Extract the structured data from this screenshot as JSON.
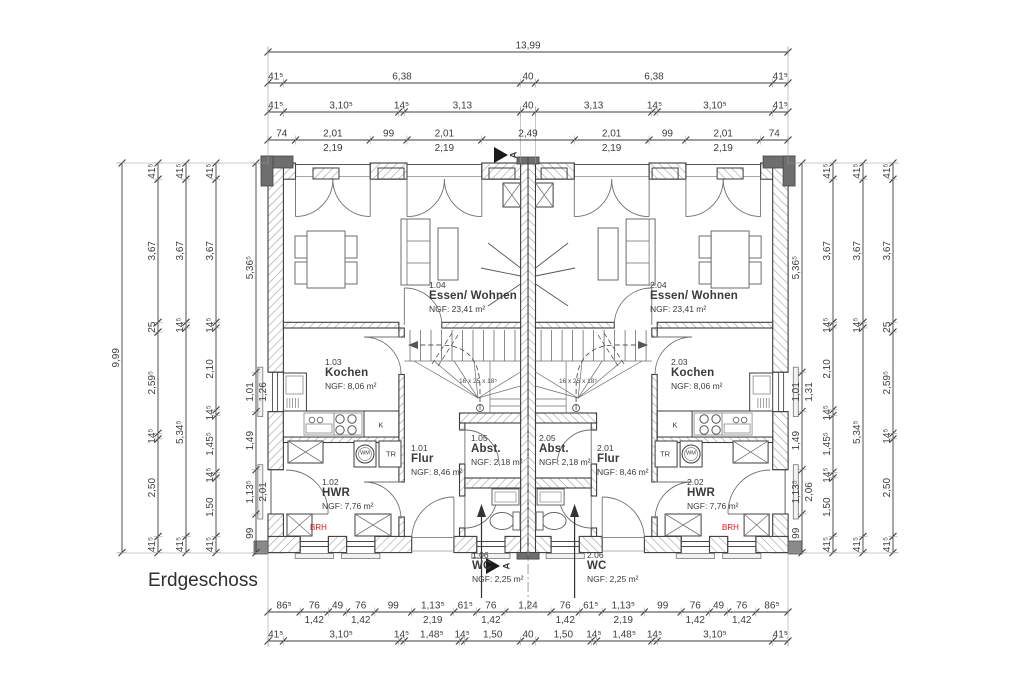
{
  "title": {
    "floor_label": "Erdgeschoss"
  },
  "labels": {
    "fridge": "K",
    "dryer": "TR",
    "washer": "WM",
    "brh": "BRH",
    "stair_spec": "16 x 25 x 18⁵",
    "section": "A"
  },
  "colors": {
    "line": "#3d3d3d",
    "hatch": "#a0a0a0",
    "furniture": "#6d6d6d",
    "dark_fill": "#6e6e6e",
    "accent_red": "#cc2222",
    "background": "#ffffff"
  },
  "units": [
    {
      "id": "1",
      "rooms": {
        "flur": {
          "number": "1.01",
          "name": "Flur",
          "area": "NGF: 8,46 m²"
        },
        "hwr": {
          "number": "1.02",
          "name": "HWR",
          "area": "NGF: 7,76 m²"
        },
        "kochen": {
          "number": "1.03",
          "name": "Kochen",
          "area": "NGF: 8,06 m²"
        },
        "wohnen": {
          "number": "1.04",
          "name": "Essen/ Wohnen",
          "area": "NGF: 23,41 m²"
        },
        "abst": {
          "number": "1.05",
          "name": "Abst.",
          "area": "NGF: 2,18 m²"
        },
        "wc": {
          "number": "1.06",
          "name": "WC",
          "area": "NGF: 2,25 m²"
        }
      }
    },
    {
      "id": "2",
      "rooms": {
        "flur": {
          "number": "2.01",
          "name": "Flur",
          "area": "NGF: 8,46 m²"
        },
        "hwr": {
          "number": "2.02",
          "name": "HWR",
          "area": "NGF: 7,76 m²"
        },
        "kochen": {
          "number": "2.03",
          "name": "Kochen",
          "area": "NGF: 8,06 m²"
        },
        "wohnen": {
          "number": "2.04",
          "name": "Essen/ Wohnen",
          "area": "NGF: 23,41 m²"
        },
        "abst": {
          "number": "2.05",
          "name": "Abst.",
          "area": "NGF: 2,18 m²"
        },
        "wc": {
          "number": "2.06",
          "name": "WC",
          "area": "NGF: 2,25 m²"
        }
      }
    }
  ],
  "dimensions": {
    "top_rows": [
      {
        "segments": [
          "13,99"
        ]
      },
      {
        "segments": [
          "41⁵",
          "6,38",
          "40",
          "6,38",
          "41⁵"
        ]
      },
      {
        "segments": [
          "41⁵",
          "3,10⁵",
          "14⁵",
          "3,13",
          "40",
          "3,13",
          "14⁵",
          "3,10⁵",
          "41⁵"
        ]
      },
      {
        "segments": [
          "74",
          [
            "2,01",
            "2,19"
          ],
          "99",
          [
            "2,01",
            "2,19"
          ],
          "2,49",
          [
            "2,01",
            "2,19"
          ],
          "99",
          [
            "2,01",
            "2,19"
          ],
          "74"
        ]
      }
    ],
    "left_cols": [
      {
        "segments": [
          "9,99"
        ]
      },
      {
        "segments": [
          "41⁵",
          "3,67",
          "25",
          "2,59⁵",
          "14⁵",
          "2,50",
          "41⁵"
        ]
      },
      {
        "segments": [
          "41⁵",
          "3,67",
          "14⁵",
          "5,34⁵",
          "41⁵"
        ]
      },
      {
        "segments": [
          "41⁵",
          "3,67",
          "14⁵",
          "2,10",
          "14⁵",
          "1,45⁵",
          "14⁵",
          "1,50",
          "41⁵"
        ]
      },
      {
        "segments": [
          "5,36⁵",
          [
            "1,01",
            "1,26"
          ],
          "1,49",
          [
            "1,13⁵",
            "2,01"
          ],
          "99"
        ]
      }
    ],
    "right_cols": [
      {
        "segments": [
          "5,36⁵",
          [
            "1,01",
            "1,31"
          ],
          "1,49",
          [
            "1,13⁵",
            "2,06"
          ],
          "99"
        ]
      },
      {
        "segments": [
          "41⁵",
          "3,67",
          "14⁵",
          "2,10",
          "14⁵",
          "1,45⁵",
          "14⁵",
          "1,50",
          "41⁵"
        ]
      },
      {
        "segments": [
          "41⁵",
          "3,67",
          "14⁵",
          "5,34⁵",
          "41⁵"
        ]
      },
      {
        "segments": [
          "41⁵",
          "3,67",
          "25",
          "2,59⁵",
          "14⁵",
          "2,50",
          "41⁵"
        ]
      }
    ],
    "bottom_rows": [
      {
        "segments": [
          "86⁵",
          [
            "76",
            "1,42"
          ],
          "49",
          [
            "76",
            "1,42"
          ],
          "99",
          [
            "1,13⁵",
            "2,19"
          ],
          "61⁵",
          [
            "76",
            "1,42"
          ],
          "1,24",
          [
            "76",
            "1,42"
          ],
          "61⁵",
          [
            "1,13⁵",
            "2,19"
          ],
          "99",
          [
            "76",
            "1,42"
          ],
          "49",
          [
            "76",
            "1,42"
          ],
          "86⁵"
        ]
      },
      {
        "segments": [
          "41⁵",
          "3,10⁵",
          "14⁵",
          "1,48⁵",
          "14⁵",
          "1,50",
          "40",
          "1,50",
          "14⁵",
          "1,48⁵",
          "14⁵",
          "3,10⁵",
          "41⁵"
        ]
      }
    ]
  }
}
